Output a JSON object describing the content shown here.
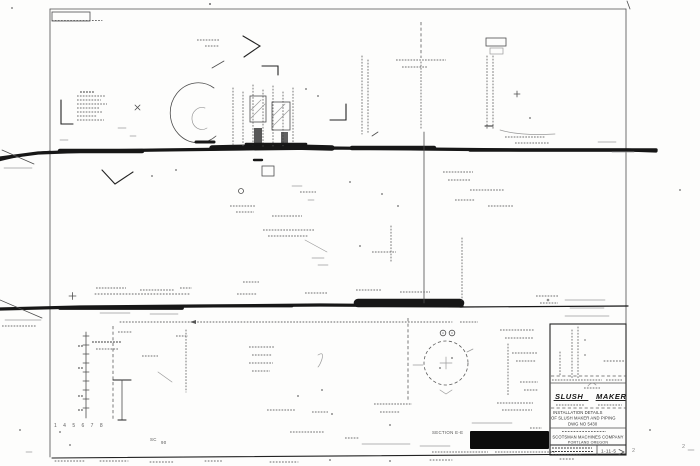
{
  "colors": {
    "paper": "#fdfdfc",
    "ink": "#1f1f1f",
    "faint_ink": "#8a8a8a",
    "redaction": "#0c0c0c"
  },
  "title_block": {
    "brand_left": "SLUSH",
    "brand_right": "MAKER",
    "title_line1": "INSTALLATION DETAILS",
    "title_line2": "OF SLUSH MAKER AND PIPING",
    "title_line3": "DWG NO 5430",
    "company_line1": "SCOTSMAN MACHINES COMPANY",
    "company_line2": "PORTLAND OREGON",
    "drawing_number": "1-11-5"
  },
  "annotations": {
    "section_label": "SECTION E-E",
    "grid_numbers": "1 4 5 6 7 8",
    "mark_sc": "SC",
    "mark_90": "90",
    "stray_mark_1": "2",
    "stray_mark_2": "2"
  }
}
